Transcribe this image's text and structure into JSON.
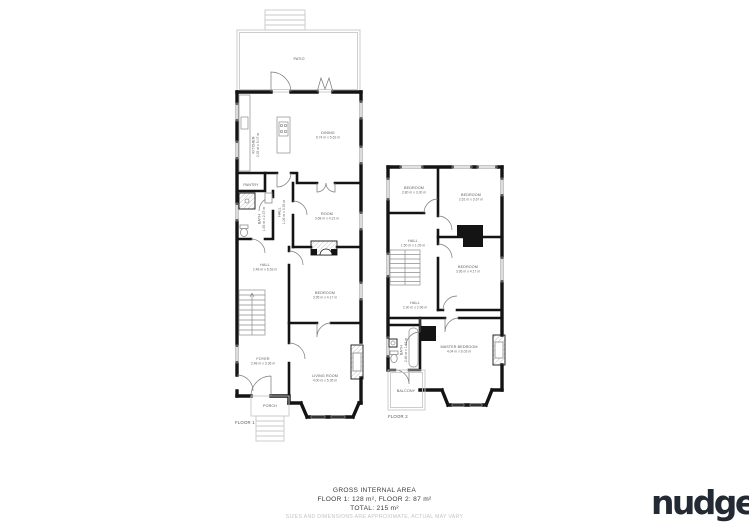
{
  "floor1": {
    "label": "FLOOR 1",
    "patio": {
      "name": "PATIO"
    },
    "kitchen": {
      "name": "KITCHEN",
      "dims": "2.35 m x 5.07 m"
    },
    "dining": {
      "name": "DINING",
      "dims": "6.74 m x 5.62 m"
    },
    "pantry": {
      "name": "PANTRY"
    },
    "bath": {
      "name": "BATH",
      "dims": "1.65 m x 2.37 m"
    },
    "hall_upper": {
      "name": "HALL",
      "dims": "1.06 m x 3.35 m"
    },
    "room": {
      "name": "ROOM",
      "dims": "3.68 m x 4.21 m"
    },
    "hall": {
      "name": "HALL",
      "dims": "2.48 m x 6.53 m"
    },
    "bedroom": {
      "name": "BEDROOM",
      "dims": "3.95 m x 4.17 m"
    },
    "foyer": {
      "name": "FOYER",
      "dims": "2.48 m x 3.36 m"
    },
    "living_room": {
      "name": "LIVING ROOM",
      "dims": "4.00 m x 5.35 m"
    },
    "porch": {
      "name": "PORCH"
    }
  },
  "floor2": {
    "label": "FLOOR 2",
    "bedroom_small": {
      "name": "BEDROOM",
      "dims": "2.80 m x 3.30 m"
    },
    "bedroom_front": {
      "name": "BEDROOM",
      "dims": "2.61 m x 3.67 m"
    },
    "hall_landing": {
      "name": "HALL",
      "dims": "1.50 m x 1.09 m"
    },
    "bedroom_mid": {
      "name": "BEDROOM",
      "dims": "3.95 m x 4.17 m"
    },
    "hall": {
      "name": "HALL",
      "dims": "2.30 m x 2.96 m"
    },
    "bath": {
      "name": "BATH",
      "dims": "2.46 m x 1.63 m"
    },
    "master_bedroom": {
      "name": "MASTER BEDROOM",
      "dims": "4.04 m x 6.03 m"
    },
    "balcony": {
      "name": "BALCONY"
    }
  },
  "summary": {
    "title": "GROSS INTERNAL AREA",
    "areas": "FLOOR 1: 128 m², FLOOR 2: 87 m²",
    "total": "TOTAL: 215 m²",
    "disclaimer": "SIZES AND DIMENSIONS ARE APPROXIMATE, ACTUAL MAY VARY"
  },
  "brand": {
    "logo_text": "nudge"
  }
}
